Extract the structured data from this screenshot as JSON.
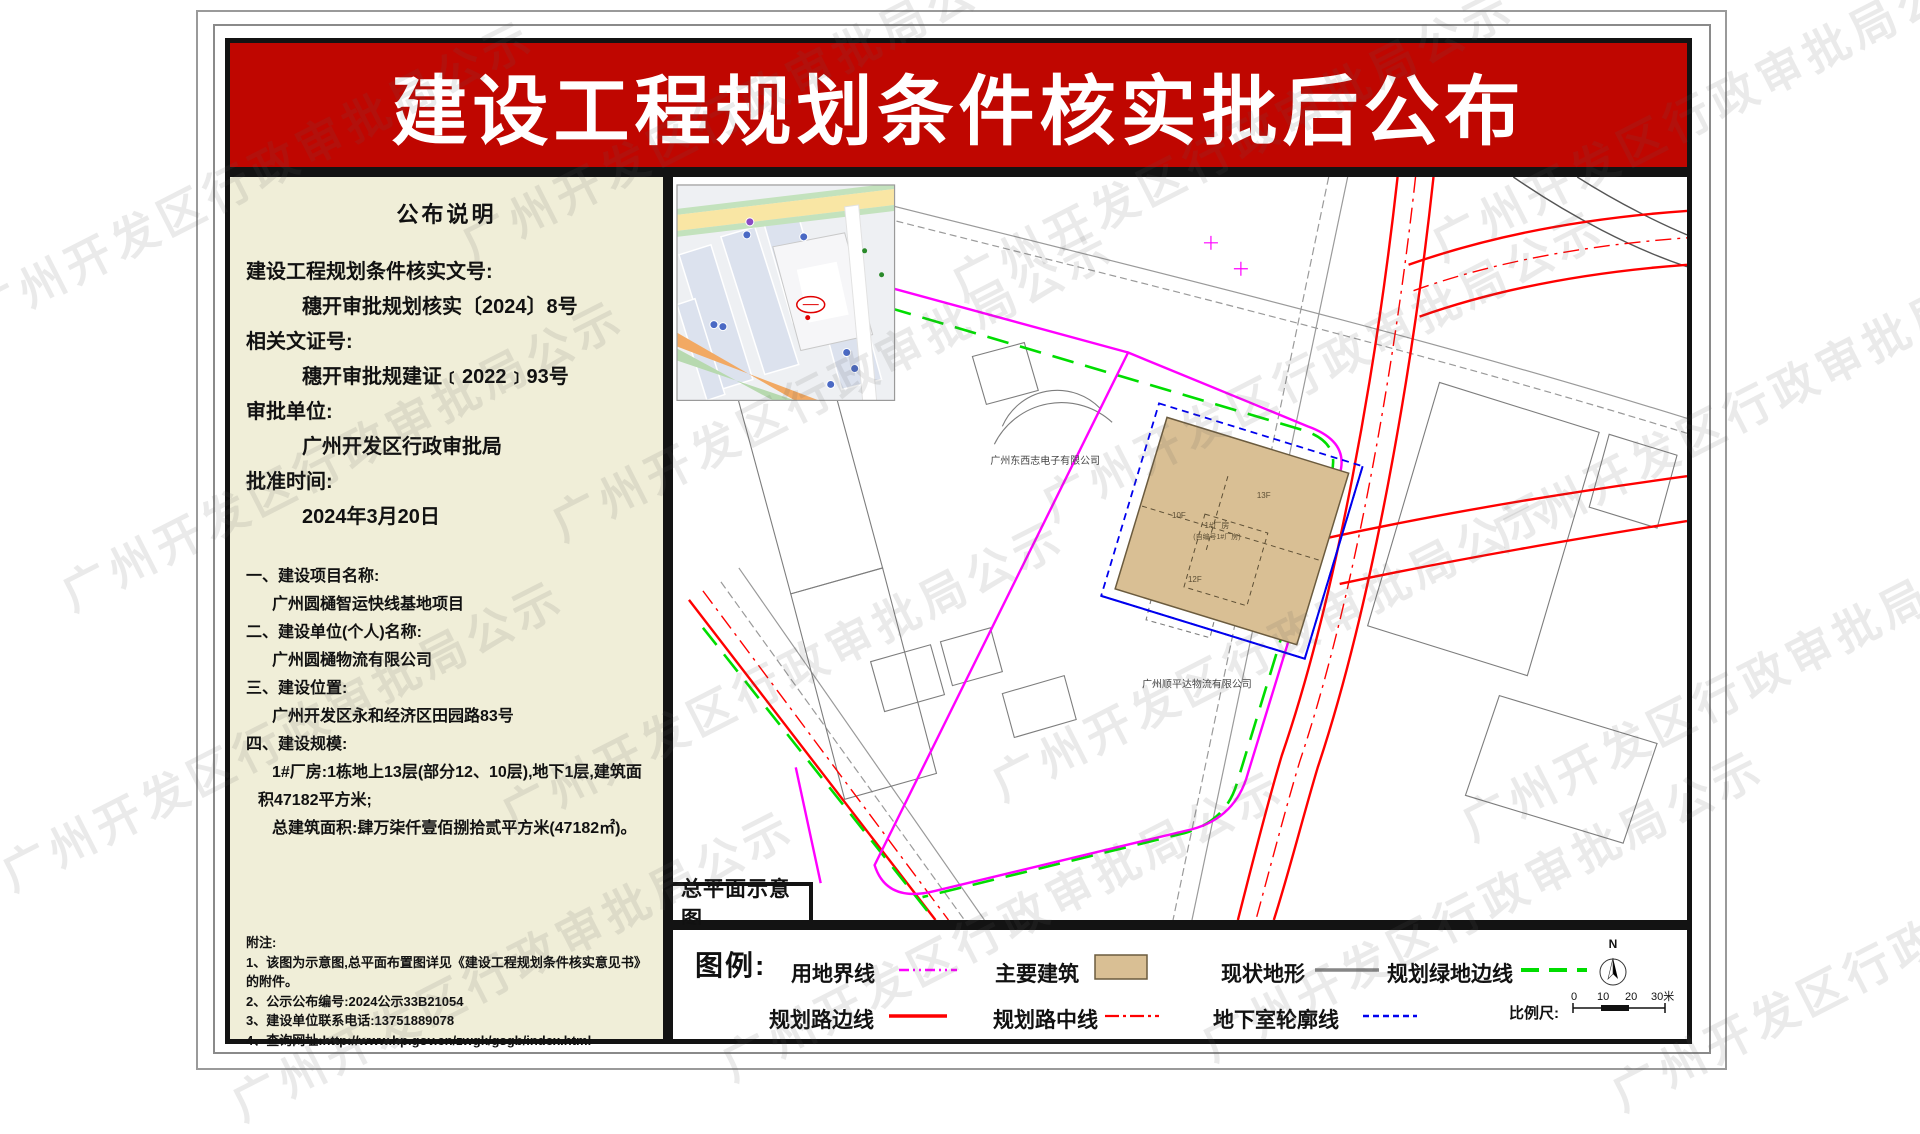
{
  "title": "建设工程规划条件核实批后公布",
  "watermark": "广州开发区行政审批局公示",
  "panel": {
    "heading": "公布说明",
    "fields": [
      {
        "label": "建设工程规划条件核实文号:",
        "value": "穗开审批规划核实〔2024〕8号"
      },
      {
        "label": "相关文证号:",
        "value": "穗开审批规建证﹝2022﹞93号"
      },
      {
        "label": "审批单位:",
        "value": "广州开发区行政审批局"
      },
      {
        "label": "批准时间:",
        "value": "2024年3月20日"
      }
    ],
    "items": [
      {
        "label": "一、建设项目名称:",
        "value": "广州圆樋智运快线基地项目"
      },
      {
        "label": "二、建设单位(个人)名称:",
        "value": "广州圆樋物流有限公司"
      },
      {
        "label": "三、建设位置:",
        "value": "广州开发区永和经济区田园路83号"
      },
      {
        "label": "四、建设规模:",
        "value1": "1#厂房:1栋地上13层(部分12、10层),地下1层,建筑面积47182平方米;",
        "value2": "总建筑面积:肆万柒仟壹佰捌拾贰平方米(47182㎡)。"
      }
    ],
    "notes_heading": "附注:",
    "notes": [
      "1、该图为示意图,总平面布置图详见《建设工程规划条件核实意见书》的附件。",
      "2、公示公布编号:2024公示33B21054",
      "3、建设单位联系电话:13751889078",
      "4、查询网址:http://www.hp.gov.cn/zwgk/gsgb/index.html"
    ]
  },
  "plan": {
    "caption": "总平面示意图",
    "labels": {
      "company1": "广州东西志电子有限公司",
      "company2": "广州顺平达物流有限公司",
      "floor_top": "13F",
      "floor_mid": "10F",
      "floor_bottom": "12F",
      "building_no": "1#厂房",
      "building_note": "(自编号1#厂房)"
    }
  },
  "legend": {
    "heading": "图例:",
    "items": [
      {
        "label": "用地界线",
        "type": "line",
        "style": "dashdotdot",
        "color": "#ff00ff"
      },
      {
        "label": "主要建筑",
        "type": "rect",
        "fill": "#d9bf94",
        "border": "#6b5b3e"
      },
      {
        "label": "现状地形",
        "type": "line",
        "style": "solid",
        "color": "#868686"
      },
      {
        "label": "规划绿地边线",
        "type": "line",
        "style": "longdash",
        "color": "#00dd00"
      },
      {
        "label": "规划路边线",
        "type": "line",
        "style": "solid",
        "color": "#ff0000"
      },
      {
        "label": "规划路中线",
        "type": "line",
        "style": "dashdot",
        "color": "#ff0000"
      },
      {
        "label": "地下室轮廓线",
        "type": "line",
        "style": "dash",
        "color": "#0000ee"
      }
    ],
    "north": "N",
    "scale": {
      "label": "比例尺:",
      "ticks": [
        "0",
        "10",
        "20",
        "30米"
      ]
    }
  },
  "colors": {
    "banner": "#bf0600",
    "panel_bg": "#f0eed8",
    "boundary": "#ff00ff",
    "road": "#ff0000",
    "green_edge": "#00dd00",
    "underground": "#0000ee",
    "terrain": "#868686",
    "building": "#d9bf94"
  }
}
